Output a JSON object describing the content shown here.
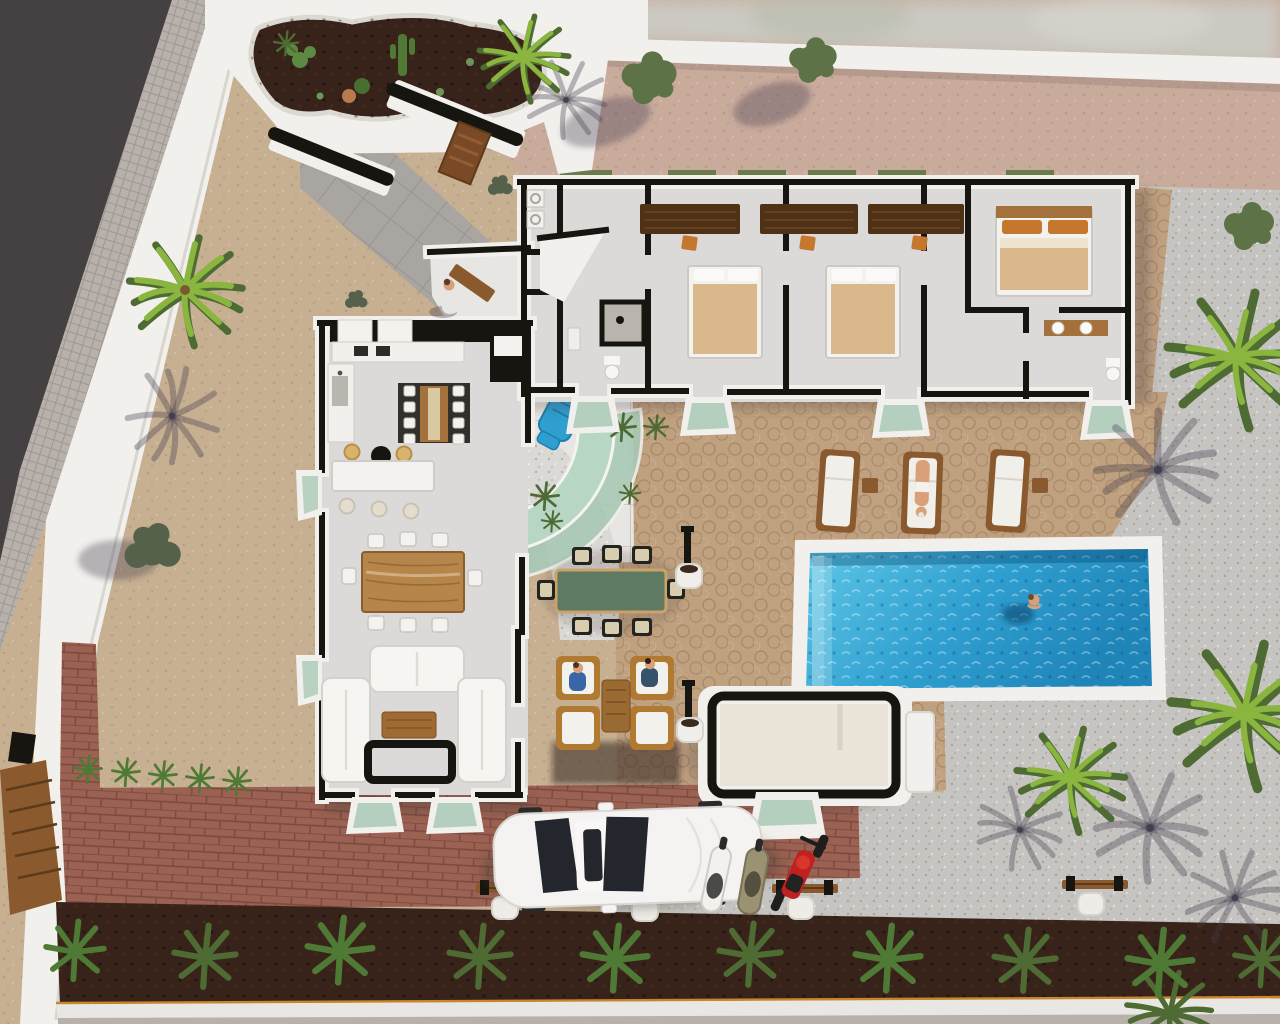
{
  "meta": {
    "kind": "aerial-3d-architectural-render",
    "subject": "single-storey modern villa plot with pool, terraces and parking",
    "view": "top-down oblique"
  },
  "palette": {
    "street": "#454143",
    "sidewalk": "#b7b0ab",
    "wallWhite": "#f2f0ec",
    "wallBlack": "#17150f",
    "pinkGravel": "#c9ab9c",
    "sand": "#c7b091",
    "cobbleTan": "#bfa07f",
    "gravelLight": "#c6c4c0",
    "gravelWhite": "#dbd9d5",
    "floorGray": "#dcdad8",
    "tileWhite": "#e8e6e2",
    "paverGray": "#a9a6a1",
    "brickRed": "#9b6152",
    "soilDark": "#38231a",
    "curbWhite": "#e9e7e3",
    "curbLine": "#c8862c",
    "shrubGreen": "#4f7a36",
    "palmBright": "#8ab53e",
    "palmDark": "#4e6b33",
    "treeGreen": "#5d7247",
    "bushOlive": "#55614b",
    "poolDeep": "#1f85b9",
    "poolLight": "#62c9e8",
    "glassGreen": "#a9c9b6",
    "glassDark": "#23262c",
    "woodBrown": "#a4703b",
    "woodDark": "#5d3a1c",
    "awningBrown": "#4f3116",
    "bedTan": "#d9b98c",
    "accentOrange": "#c5772e",
    "cushionBeige": "#d9cdb0",
    "skinTone": "#d9a07a",
    "blueItem": "#2f9fd0",
    "carWhite": "#f4f3f1",
    "benchWood": "#8a5a2e",
    "shadowTint": "rgba(66,60,78,0.35)"
  },
  "scene": {
    "boundary": {
      "street_position": "top-left diagonal",
      "perimeter_wall": "white rendered wall",
      "entrance": "curved white walls with cactus planter, black gate caps and timber sign",
      "side_gate": "timber slatted gate on left wall"
    },
    "house": {
      "wings": [
        "bedroom-wing (top)",
        "kitchen-living-wing (left)"
      ],
      "rooms": [
        "laundry",
        "bathroom-1",
        "bedroom-1",
        "bedroom-2",
        "hallway",
        "master-bedroom",
        "ensuite-bathroom",
        "kitchen",
        "indoor-dining",
        "living-room",
        "entry-hall"
      ],
      "furniture": {
        "double_beds": 3,
        "bedroom_desk_chairs": 3,
        "window_awnings": 3,
        "sofas": 3,
        "coffee_table": 1,
        "indoor_dining_seats": 8,
        "kitchen_island_stools": 3,
        "fireplace": 1
      }
    },
    "outdoor": {
      "pool": {
        "shape": "rectangular",
        "border": "white",
        "swimmers": 1
      },
      "plunge_pool": "curved glass-edged splash pool with blue lounger",
      "pool_house": 1,
      "sun_loungers": 3,
      "outdoor_dining_seats": 8,
      "lounge_armchairs": 4,
      "lamp_planters": 2,
      "benches_with_planters": 4
    },
    "vehicles": {
      "car": "white sedan (top view)",
      "scooters": 2,
      "motorcycle": "red"
    },
    "vegetation": {
      "palm_trees": 6,
      "leafy_trees": 3,
      "olive_bushes": 2,
      "small_shrub_row": 5,
      "soil_bed_shrubs": 10,
      "cactus_planter": 1
    },
    "people": [
      {
        "where": "entry-courtyard",
        "pose": "standing"
      },
      {
        "where": "outdoor-lounge",
        "pose": "seated",
        "count": 2
      },
      {
        "where": "sun-lounger",
        "pose": "lying"
      },
      {
        "where": "pool",
        "pose": "swimming"
      }
    ]
  }
}
